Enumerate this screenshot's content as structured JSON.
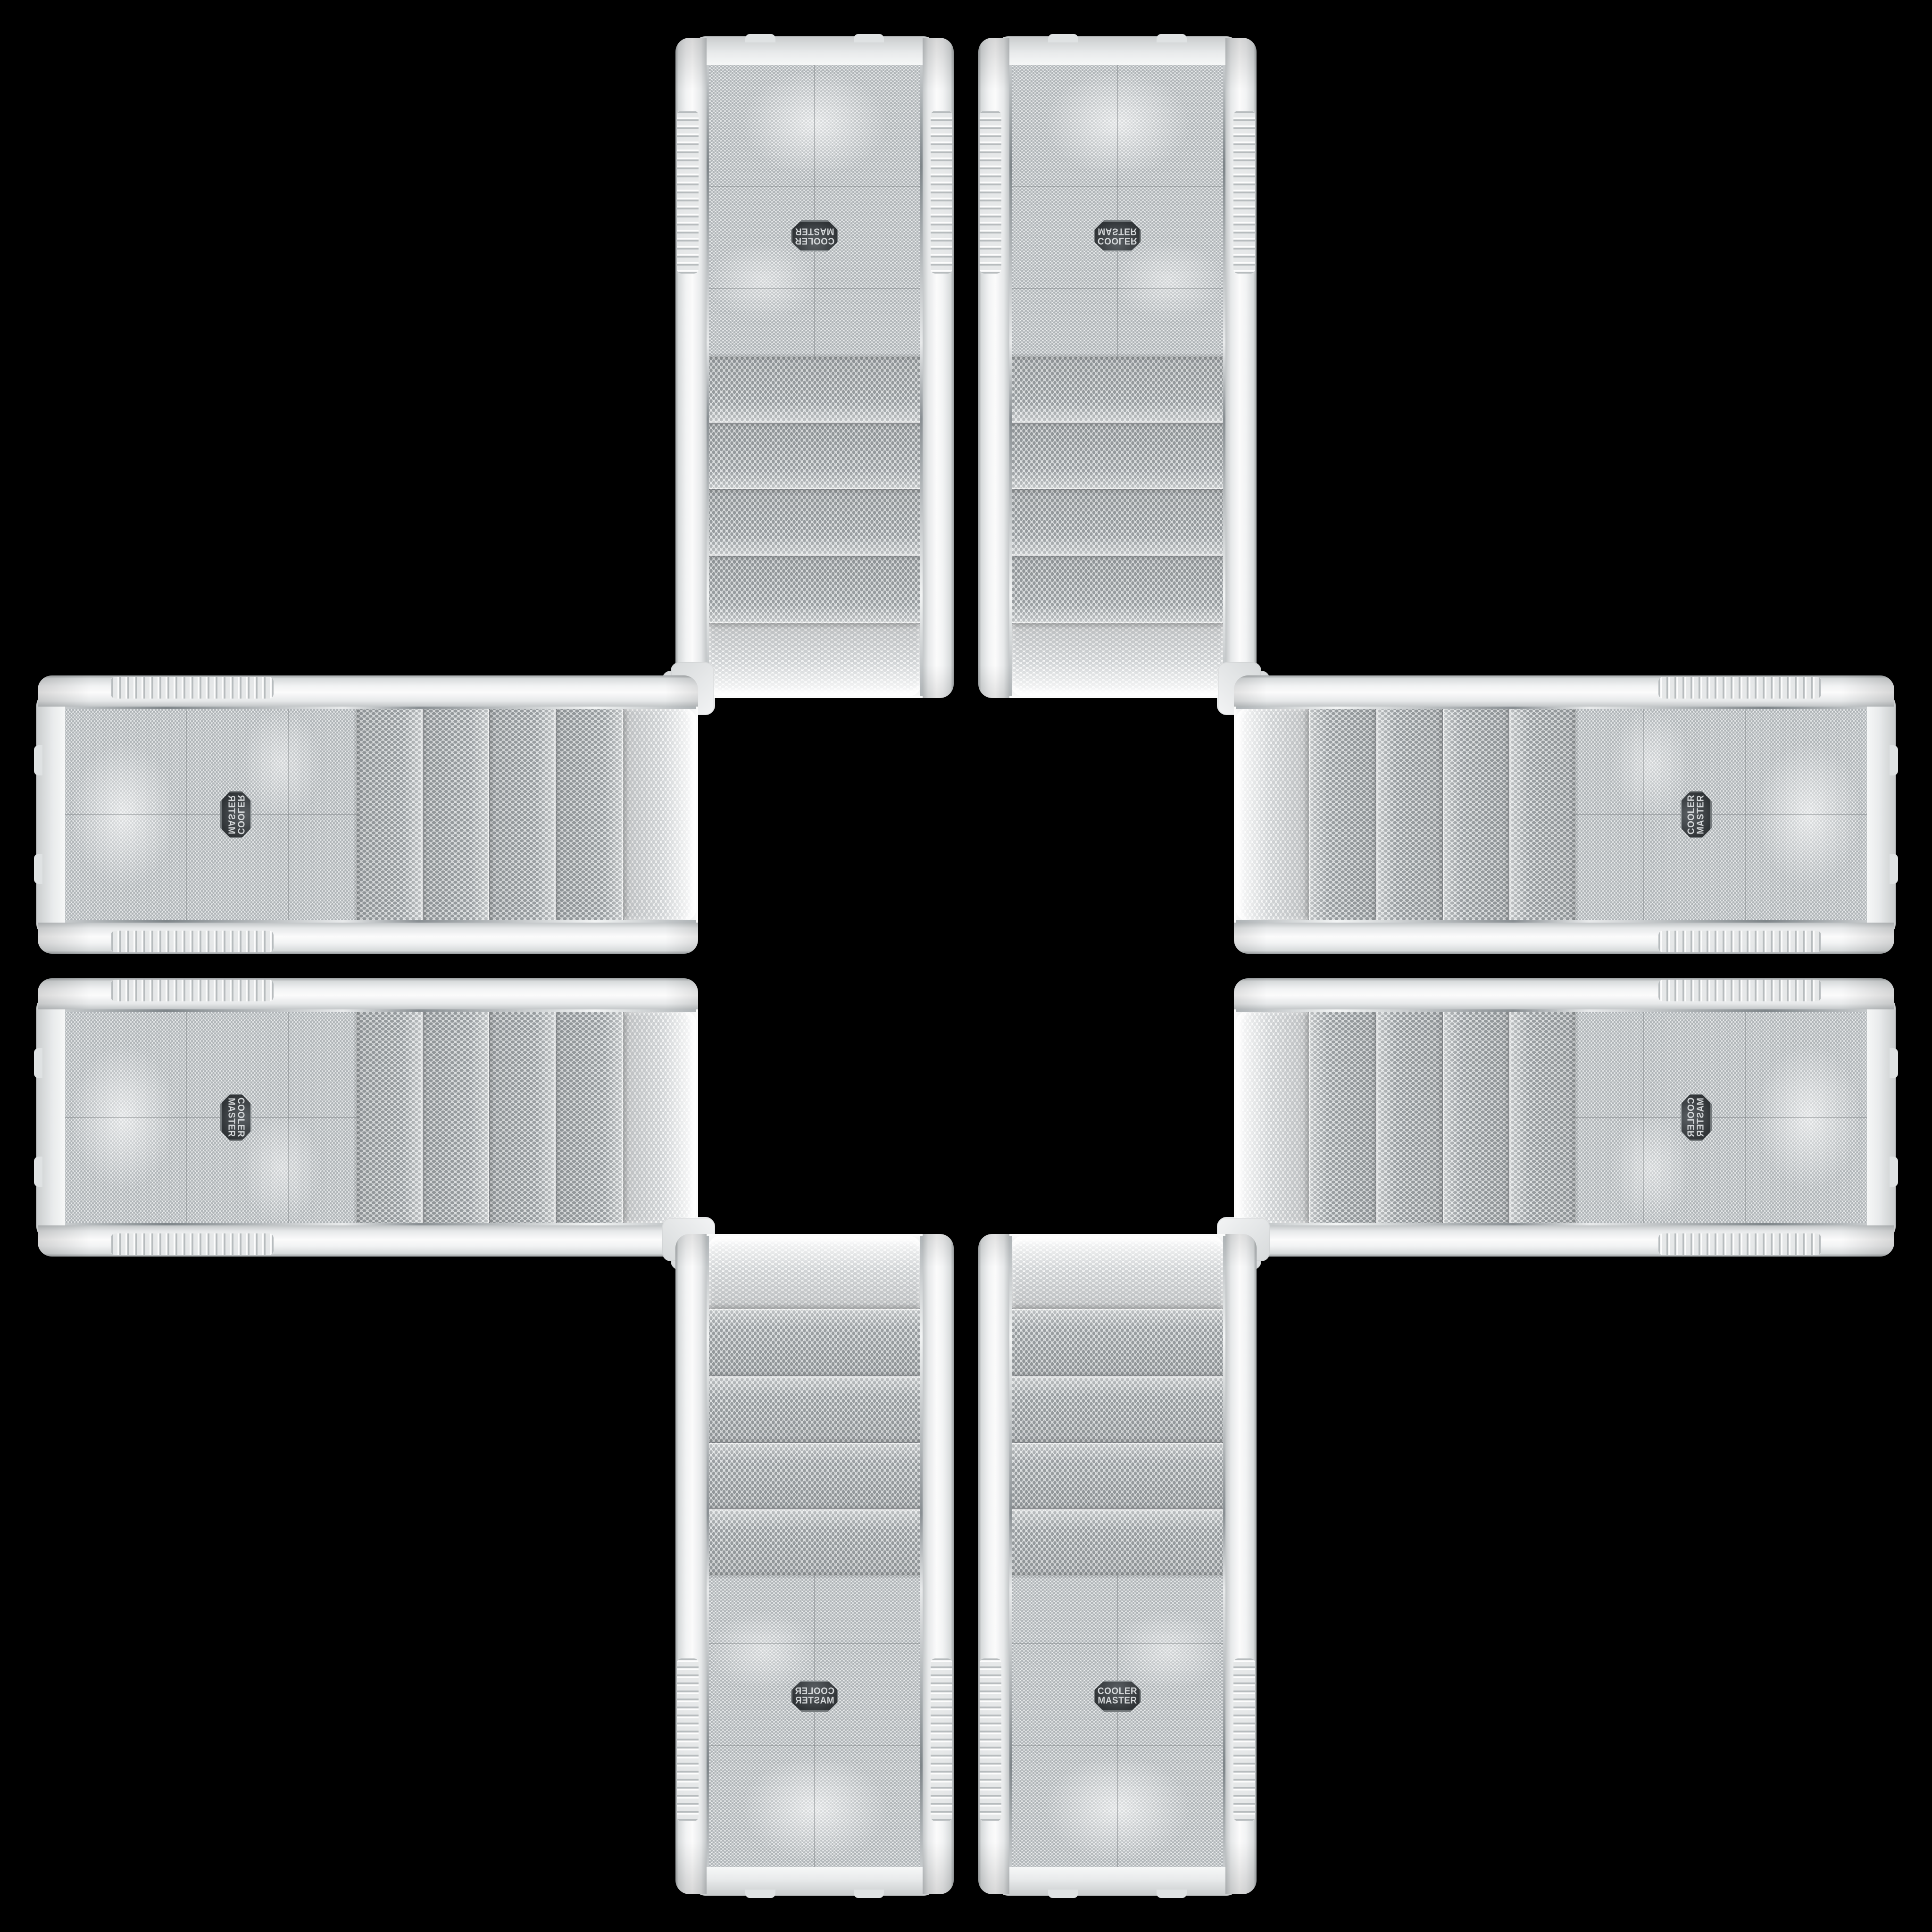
{
  "scene": {
    "background_color": "#000000",
    "panel_count": 8,
    "arrangement": "cross"
  },
  "brand": {
    "line1": "COOLER",
    "line2": "MASTER"
  },
  "colors": {
    "background": "#000000",
    "shell": "#eef0f1",
    "shell_shadow": "#c2c6c8",
    "mesh_base": "#e9ebec",
    "mesh_dot": "#9aa0a3",
    "chrome": "#8d9296",
    "badge_background": "#303437",
    "badge_text": "#d5d8da"
  },
  "panels": [
    {
      "id": "top-left",
      "orientation": "vertical",
      "mirror": "rotated-180"
    },
    {
      "id": "top-right",
      "orientation": "vertical",
      "mirror": "flipped-vertical"
    },
    {
      "id": "left-top",
      "orientation": "horizontal",
      "mirror": "rotated-mirrored"
    },
    {
      "id": "right-top",
      "orientation": "horizontal",
      "mirror": "rotated"
    },
    {
      "id": "left-bottom",
      "orientation": "horizontal",
      "mirror": "rotated"
    },
    {
      "id": "right-bottom",
      "orientation": "horizontal",
      "mirror": "rotated-mirrored"
    },
    {
      "id": "bottom-left",
      "orientation": "vertical",
      "mirror": "flipped-horizontal"
    },
    {
      "id": "bottom-right",
      "orientation": "vertical",
      "mirror": "none"
    }
  ]
}
